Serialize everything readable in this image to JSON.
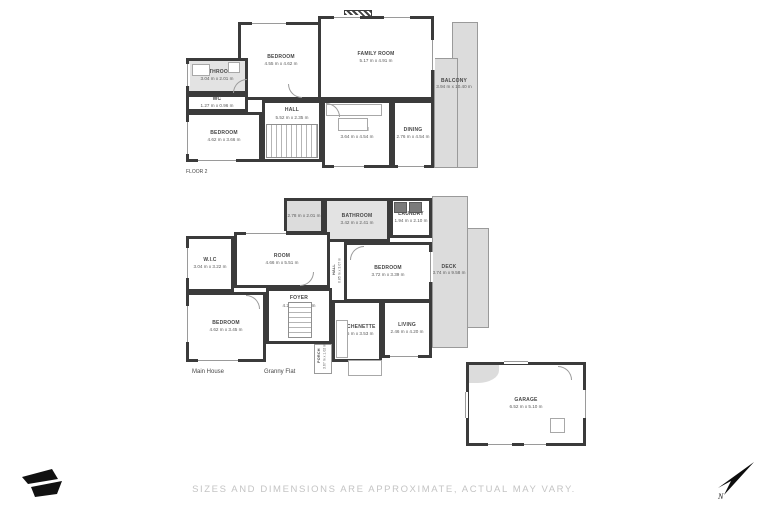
{
  "floor2": {
    "label": "FLOOR 2",
    "rooms": {
      "bedroom_top": {
        "name": "BEDROOM",
        "dims": "4.55 m x 4.62 m"
      },
      "family_room": {
        "name": "FAMILY ROOM",
        "dims": "5.17 m x 4.91 m"
      },
      "bathroom": {
        "name": "BATHROOM",
        "dims": "3.04 m x 2.01 m"
      },
      "wc": {
        "name": "WC",
        "dims": "1.27 m x 0.96 m"
      },
      "bedroom_left": {
        "name": "BEDROOM",
        "dims": "4.62 m x 3.66 m"
      },
      "hall": {
        "name": "HALL",
        "dims": "5.52 m x 2.35 m"
      },
      "kitchen": {
        "name": "KITCHEN",
        "dims": "3.64 m x 4.54 m"
      },
      "dining": {
        "name": "DINING",
        "dims": "2.76 m x 4.54 m"
      },
      "balcony": {
        "name": "BALCONY",
        "dims": "3.94 m x 10.40 m"
      }
    }
  },
  "ground": {
    "main_house_label": "Main House",
    "granny_flat_label": "Granny Flat",
    "rooms": {
      "store": {
        "name": "",
        "dims": "2.78 m x 2.01 m"
      },
      "bathroom": {
        "name": "BATHROOM",
        "dims": "3.42 m x 2.41 m"
      },
      "laundry": {
        "name": "LAUNDRY",
        "dims": "1.94 m x 2.10 m"
      },
      "room": {
        "name": "ROOM",
        "dims": "4.66 m x 5.51 m"
      },
      "wic": {
        "name": "W.I.C",
        "dims": "3.04 m x 3.22 m"
      },
      "bedroom_right": {
        "name": "BEDROOM",
        "dims": "3.72 m x 3.39 m"
      },
      "foyer": {
        "name": "FOYER",
        "dims": "4.20 m x 3.06 m"
      },
      "bedroom_left": {
        "name": "BEDROOM",
        "dims": "4.62 m x 3.45 m"
      },
      "kitchenette": {
        "name": "KITCHENETTE",
        "dims": "2.75 m x 3.53 m"
      },
      "living": {
        "name": "LIVING",
        "dims": "2.46 m x 4.20 m"
      },
      "deck": {
        "name": "DECK",
        "dims": "3.74 m x 9.58 m"
      },
      "porch": {
        "name": "PORCH",
        "dims": "3.67 m x 1.02 m"
      },
      "hall_small": {
        "name": "HALL",
        "dims": "0.85 m x 3.07 m"
      }
    }
  },
  "garage": {
    "name": "GARAGE",
    "dims": "6.52 m x 5.10 m"
  },
  "footer": {
    "disclaimer": "SIZES AND DIMENSIONS ARE APPROXIMATE, ACTUAL MAY VARY."
  },
  "compass": {
    "north_label": "N"
  },
  "colors": {
    "wall": "#3b3b3b",
    "outdoor_fill": "#dcdcdc",
    "wet_room_fill": "#e3e3e3",
    "room_text": "#474747",
    "footer_text": "#c4c4c4",
    "logo": "#111111"
  }
}
